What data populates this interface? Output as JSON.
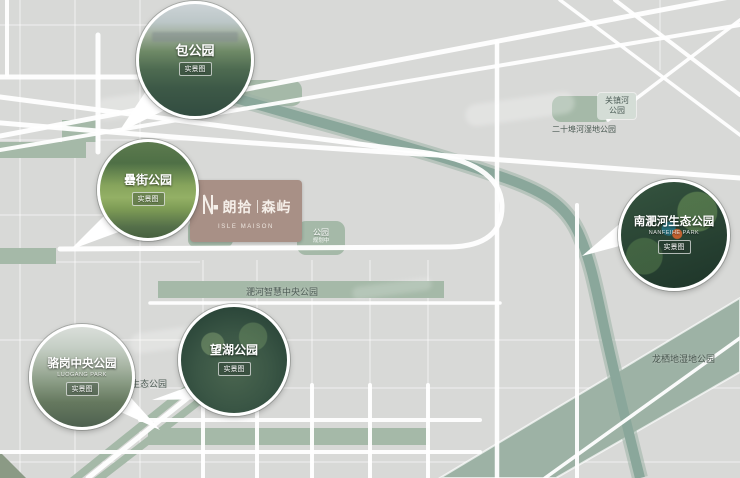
{
  "project": {
    "name_left": "朗拾",
    "name_right": "森屿",
    "english": "ISLE MAISON"
  },
  "parks": {
    "bao": {
      "name": "包公园",
      "badge": "实景图"
    },
    "leijie": {
      "name": "罍街公园",
      "badge": "实景图"
    },
    "luogang": {
      "name": "骆岗中央公园",
      "sub_en": "LUOGANG PARK",
      "badge": "实景图"
    },
    "wanghu": {
      "name": "望湖公园",
      "badge": "实景图"
    },
    "nanfeihe": {
      "name": "南淝河生态公园",
      "sub_en": "NANFEIHE PARK",
      "badge": "实景图"
    }
  },
  "map_labels": {
    "feihe_smart_central_park": "淝河智慧中央公园",
    "feihe_eco_park": "淝河生态公园",
    "longqidi_wetland_park": "龙栖地湿地公园",
    "guanzhenhe_line1": "关镇河",
    "guanzhenhe_line2": "公园",
    "ershilipuhe_wetland_park": "二十埠河湿地公园",
    "planned_park_1": "公园",
    "planned_park_1_sub": "规划中",
    "planned_park_2": "公园",
    "planned_park_2_sub": "规划中"
  },
  "colors": {
    "background": "#d8d9d7",
    "road": "#ffffff",
    "park_green": "#a5b9a8",
    "river_teal": "#8aa79b",
    "greenway_band": "#9db2a5",
    "logo_card": "#a89086",
    "label_text": "#4b5a53"
  }
}
